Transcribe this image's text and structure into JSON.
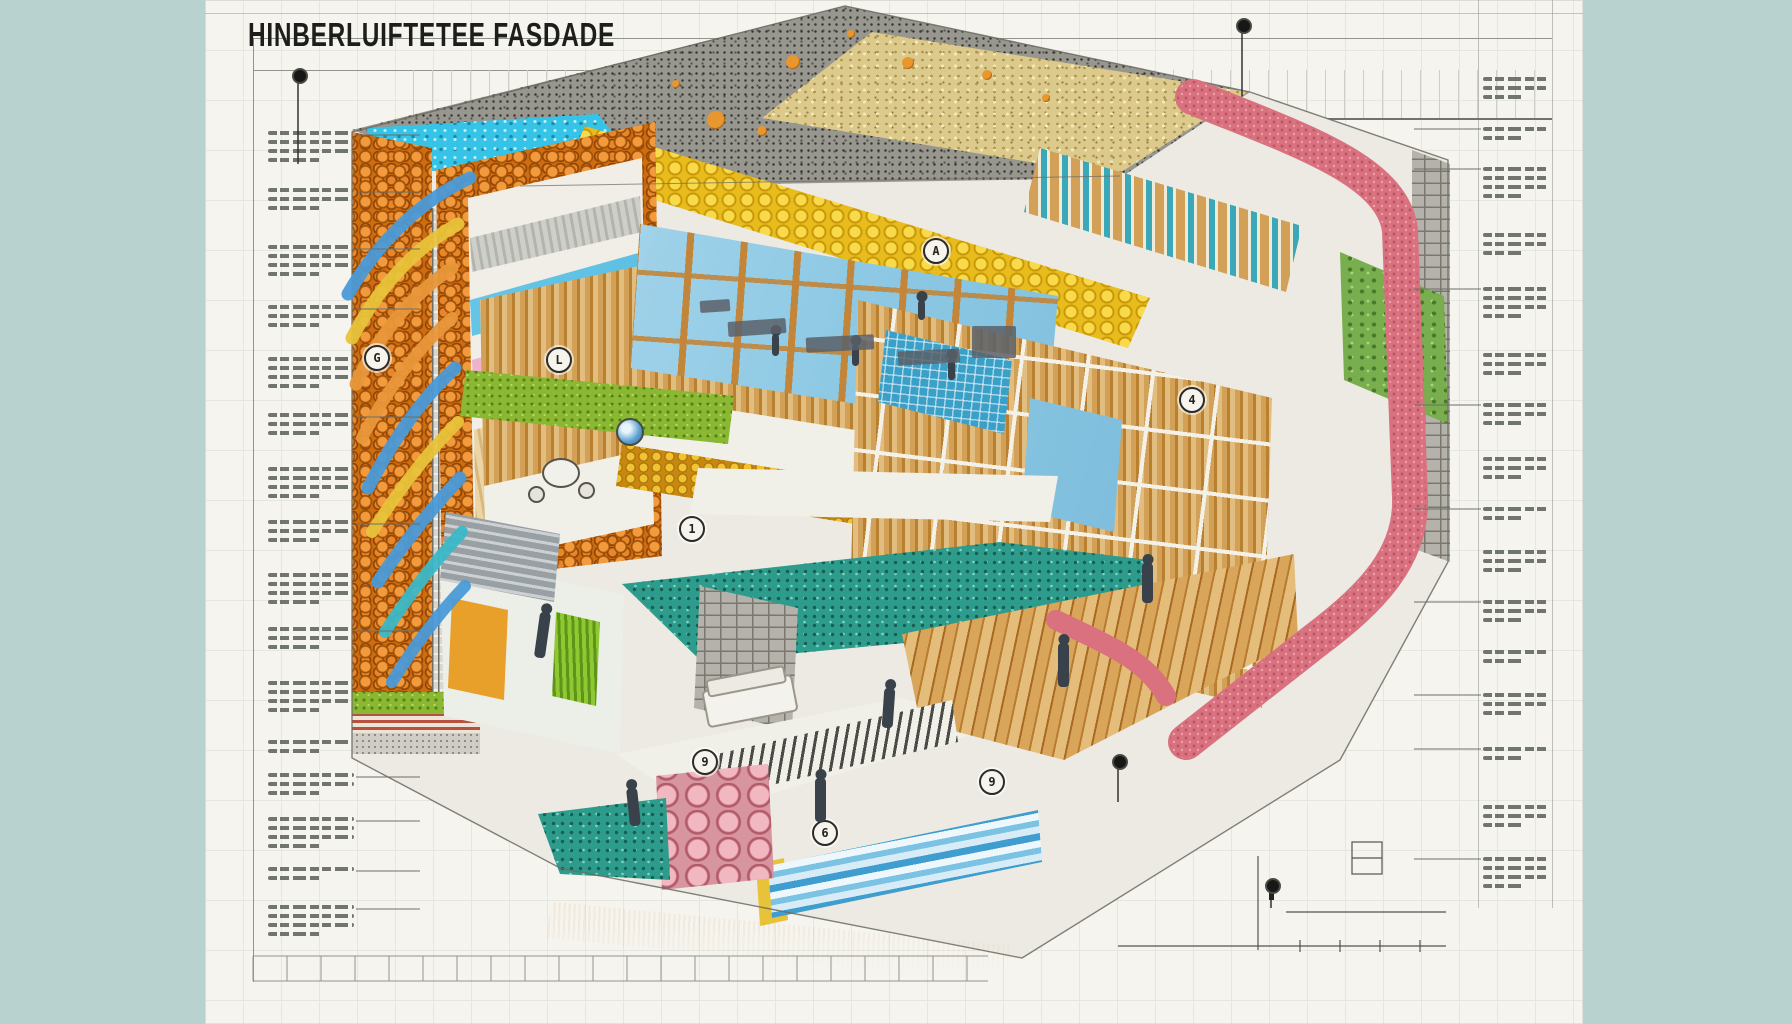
{
  "title": {
    "text": "HINBERLUIFTETEE FASDADE"
  },
  "palette": {
    "background": "#b7d2cf",
    "sheet": "#f5f4ee",
    "ink": "#1d1d1b",
    "annotation": "#70756e",
    "roof_membrane": "#97968f",
    "roof_gravel": "#dcc98c",
    "insulation_cyan": "#35c4e8",
    "insulation_foam": "#e9bc1e",
    "facade_orange": "#cf6d0e",
    "insulation_pink": "#d9717f",
    "wood": "#d2a057",
    "glass": "#8ec9e4",
    "stone_teal": "#2d9c8c",
    "stone_green": "#79ae4e",
    "foundation_gold": "#cf8e12"
  },
  "annotations": {
    "left": {
      "x": 268,
      "width": 86,
      "blocks": [
        {
          "y": 126,
          "lines": 4,
          "leader": true
        },
        {
          "y": 183,
          "lines": 3,
          "leader": true
        },
        {
          "y": 240,
          "lines": 4,
          "leader": true
        },
        {
          "y": 300,
          "lines": 3,
          "leader": true
        },
        {
          "y": 352,
          "lines": 4,
          "leader": false
        },
        {
          "y": 408,
          "lines": 3,
          "leader": true
        },
        {
          "y": 462,
          "lines": 4,
          "leader": false
        },
        {
          "y": 515,
          "lines": 3,
          "leader": true
        },
        {
          "y": 568,
          "lines": 4,
          "leader": false
        },
        {
          "y": 622,
          "lines": 3,
          "leader": true
        },
        {
          "y": 676,
          "lines": 4,
          "leader": false
        },
        {
          "y": 735,
          "lines": 2,
          "leader": false
        },
        {
          "y": 768,
          "lines": 3,
          "leader": true
        },
        {
          "y": 812,
          "lines": 4,
          "leader": true
        },
        {
          "y": 862,
          "lines": 2,
          "leader": true
        },
        {
          "y": 900,
          "lines": 4,
          "leader": true
        }
      ]
    },
    "right": {
      "x": 1483,
      "width": 64,
      "blocks": [
        {
          "y": 72,
          "lines": 3,
          "leader": false
        },
        {
          "y": 122,
          "lines": 2,
          "leader": true
        },
        {
          "y": 162,
          "lines": 4,
          "leader": true
        },
        {
          "y": 228,
          "lines": 3,
          "leader": false
        },
        {
          "y": 282,
          "lines": 4,
          "leader": true
        },
        {
          "y": 348,
          "lines": 3,
          "leader": false
        },
        {
          "y": 398,
          "lines": 3,
          "leader": true
        },
        {
          "y": 452,
          "lines": 3,
          "leader": false
        },
        {
          "y": 502,
          "lines": 2,
          "leader": true
        },
        {
          "y": 545,
          "lines": 3,
          "leader": false
        },
        {
          "y": 595,
          "lines": 3,
          "leader": true
        },
        {
          "y": 645,
          "lines": 2,
          "leader": false
        },
        {
          "y": 688,
          "lines": 3,
          "leader": true
        },
        {
          "y": 742,
          "lines": 2,
          "leader": true
        },
        {
          "y": 800,
          "lines": 3,
          "leader": false
        },
        {
          "y": 852,
          "lines": 4,
          "leader": true
        }
      ]
    }
  },
  "markers": [
    {
      "x": 375,
      "y": 356,
      "glyph": "G"
    },
    {
      "x": 557,
      "y": 358,
      "glyph": "L"
    },
    {
      "x": 934,
      "y": 249,
      "glyph": "A"
    },
    {
      "x": 690,
      "y": 527,
      "glyph": "1"
    },
    {
      "x": 703,
      "y": 760,
      "glyph": "9"
    },
    {
      "x": 823,
      "y": 831,
      "glyph": "6"
    },
    {
      "x": 990,
      "y": 780,
      "glyph": "9"
    },
    {
      "x": 1190,
      "y": 398,
      "glyph": "4"
    }
  ],
  "pins": [
    {
      "x": 298,
      "y": 74,
      "stem": 84
    },
    {
      "x": 1242,
      "y": 24,
      "stem": 66
    },
    {
      "x": 1271,
      "y": 884,
      "stem": 18
    },
    {
      "x": 1118,
      "y": 760,
      "stem": 36
    }
  ],
  "people": [
    {
      "x": 537,
      "y": 612,
      "h": 46,
      "r": 8
    },
    {
      "x": 815,
      "y": 778,
      "h": 44,
      "r": 0
    },
    {
      "x": 1058,
      "y": 643,
      "h": 44,
      "r": 0
    },
    {
      "x": 1142,
      "y": 563,
      "h": 40,
      "r": 0
    },
    {
      "x": 628,
      "y": 788,
      "h": 38,
      "r": -6
    },
    {
      "x": 883,
      "y": 688,
      "h": 40,
      "r": 4
    },
    {
      "x": 772,
      "y": 334,
      "h": 22,
      "r": 0
    },
    {
      "x": 852,
      "y": 344,
      "h": 22,
      "r": 0
    },
    {
      "x": 948,
      "y": 358,
      "h": 22,
      "r": 0
    },
    {
      "x": 918,
      "y": 300,
      "h": 20,
      "r": 0
    }
  ],
  "furniture": [
    {
      "x": 728,
      "y": 320,
      "w": 58,
      "h": 15,
      "rot": -4
    },
    {
      "x": 806,
      "y": 336,
      "w": 68,
      "h": 15,
      "rot": -3
    },
    {
      "x": 898,
      "y": 350,
      "w": 62,
      "h": 14,
      "rot": -3
    },
    {
      "x": 972,
      "y": 326,
      "w": 44,
      "h": 32,
      "rot": 0
    },
    {
      "x": 700,
      "y": 300,
      "w": 30,
      "h": 12,
      "rot": -4
    }
  ],
  "roof_dots": [
    [
      793,
      62,
      7
    ],
    [
      716,
      120,
      9
    ],
    [
      762,
      131,
      5
    ],
    [
      908,
      63,
      6
    ],
    [
      987,
      75,
      5
    ],
    [
      1046,
      98,
      4
    ],
    [
      676,
      84,
      4
    ],
    [
      851,
      34,
      4
    ]
  ],
  "ribbons": [
    {
      "d": "M470,178 C430,196 384,232 348,294",
      "color": "#4a9ad8",
      "w": 13
    },
    {
      "d": "M458,224 C418,246 380,284 352,338",
      "color": "#e8c33a",
      "w": 13
    },
    {
      "d": "M452,268 C415,293 382,328 356,384",
      "color": "#e8973a",
      "w": 13
    },
    {
      "d": "M452,318 C418,348 388,388 362,438",
      "color": "#e8973a",
      "w": 12
    },
    {
      "d": "M455,368 C422,398 394,438 368,488",
      "color": "#4a9ad8",
      "w": 13
    },
    {
      "d": "M458,422 C428,452 400,488 372,532",
      "color": "#e8c33a",
      "w": 12
    },
    {
      "d": "M460,478 C432,508 404,542 378,582",
      "color": "#4a9ad8",
      "w": 13
    },
    {
      "d": "M462,532 C436,560 410,593 385,632",
      "color": "#3ab8c8",
      "w": 12
    },
    {
      "d": "M465,586 C440,612 414,646 392,682",
      "color": "#4a9ad8",
      "w": 12
    }
  ],
  "wrap_band": {
    "d": "M1193,97 C1300,140 1392,170 1400,230 L1410,498 C1412,556 1372,598 1316,640 L1186,742",
    "d2": "M1056,620 C1110,646 1146,660 1166,696",
    "color": "#d9717f",
    "width": 36
  },
  "foundation": {
    "right": {
      "from": [
        1000,
        965
      ],
      "to": [
        1460,
        770
      ],
      "clip": "556px 1024px,556px 880px,1160px 610px,1475px 560px,1475px 1024px",
      "bands": [
        {
          "color": "#b9b7af",
          "w": 40,
          "tx": true
        },
        {
          "color": "#d98f99",
          "w": 12,
          "tx": false
        },
        {
          "color": "#b2b23e",
          "w": 13,
          "tx": false
        },
        {
          "color": "#7cb6d8",
          "w": 12,
          "tx": false
        },
        {
          "color": "#d0901a",
          "w": 30,
          "tx": true
        },
        {
          "color": "#d795a0",
          "w": 22,
          "tx": true
        }
      ]
    },
    "left": {
      "from": [
        352,
        758
      ],
      "to": [
        1008,
        962
      ],
      "clip": "346px 700px,720px 700px,1030px 920px,1030px 1024px,346px 1024px",
      "bands": [
        {
          "color": "#b9b7af",
          "w": 26,
          "tx": true
        },
        {
          "color": "#c8c8c0",
          "w": 6,
          "tx": false
        },
        {
          "color": "#7cb6d8",
          "w": 10,
          "tx": false
        },
        {
          "color": "#d0901a",
          "w": 44,
          "tx": true
        },
        {
          "color": "#b89a5a",
          "w": 10,
          "tx": false
        }
      ]
    }
  },
  "ruler": {
    "x1": 253,
    "x2": 988,
    "y1": 956,
    "y2": 981,
    "tick": 34
  }
}
